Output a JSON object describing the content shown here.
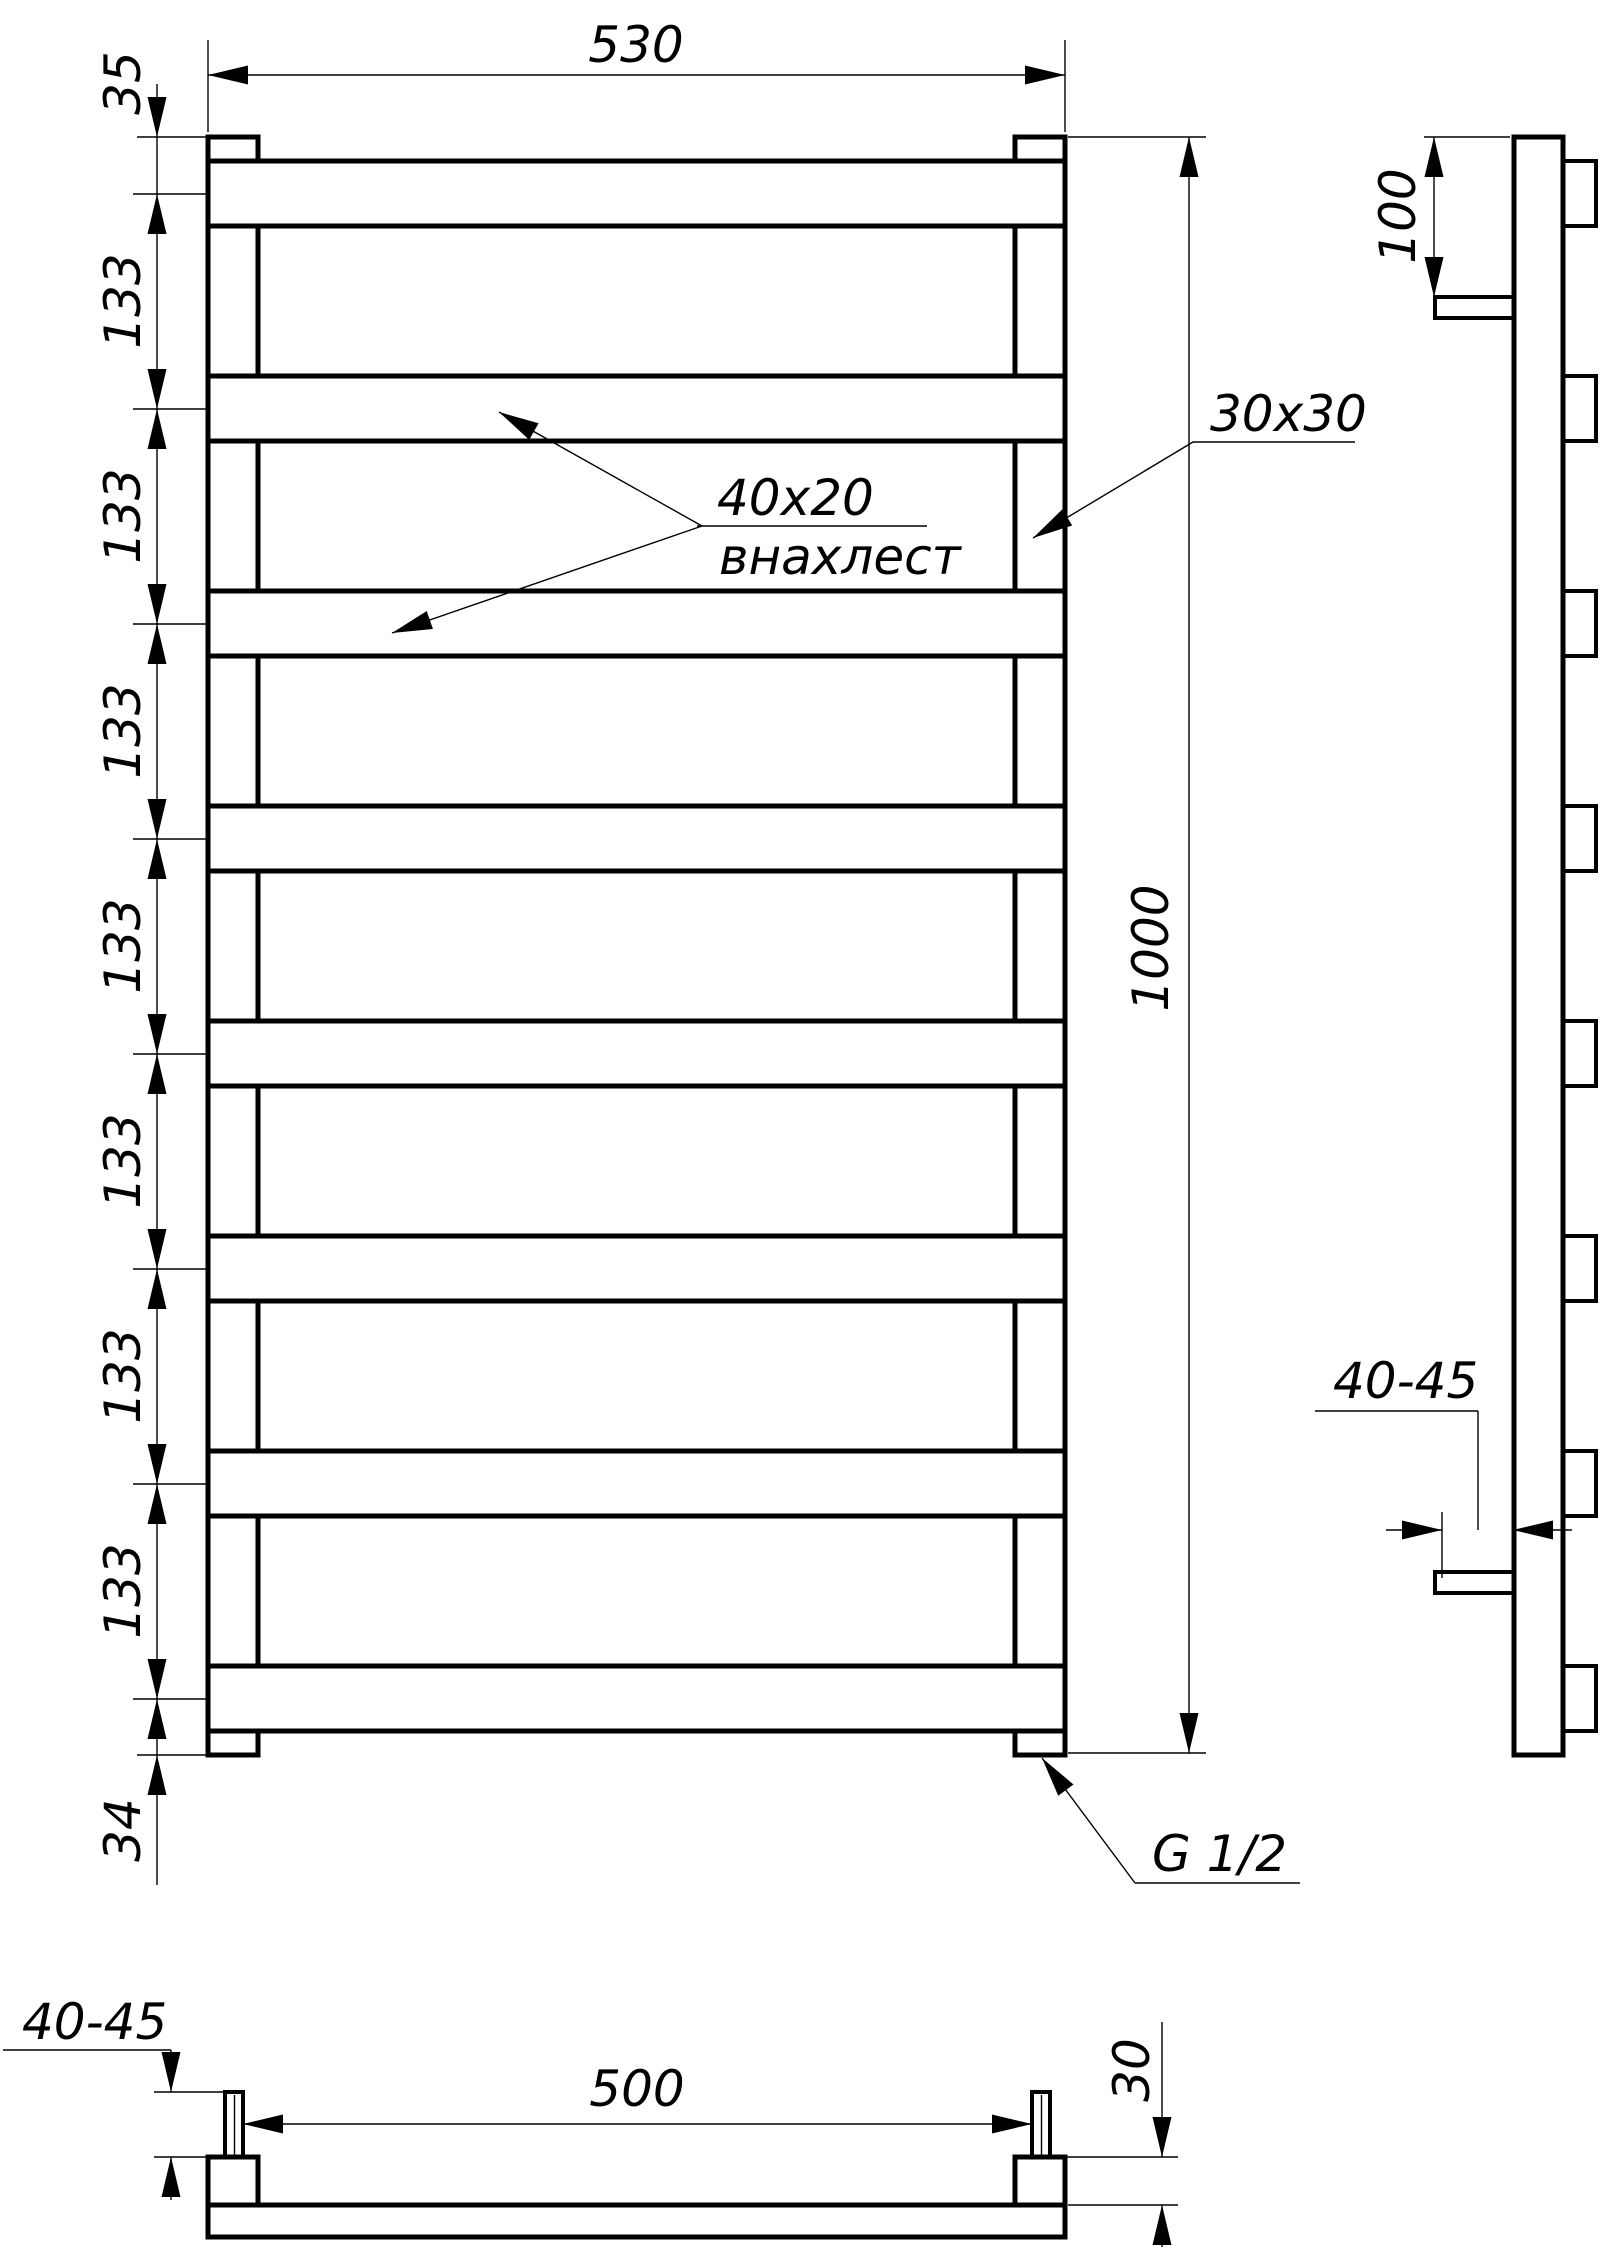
{
  "document": {
    "kind": "technical drawing of ladder towel rail",
    "background_color": "#ffffff",
    "line_color": "#000000"
  },
  "front_view": {
    "labels": {
      "width": "530",
      "top_offset": "35",
      "bottom_offset": "34",
      "height": "1000",
      "rung_profile": "40x20",
      "rung_weld": "внахлест",
      "post_profile": "30x30",
      "thread": "G 1/2"
    },
    "spacing_labels": [
      "133",
      "133",
      "133",
      "133",
      "133",
      "133",
      "133"
    ]
  },
  "side_view": {
    "labels": {
      "bracket_top_offset": "100",
      "wall_clearance": "40-45"
    }
  },
  "top_view": {
    "labels": {
      "wall_clearance": "40-45",
      "centers_distance": "500",
      "post_depth": "30"
    }
  }
}
